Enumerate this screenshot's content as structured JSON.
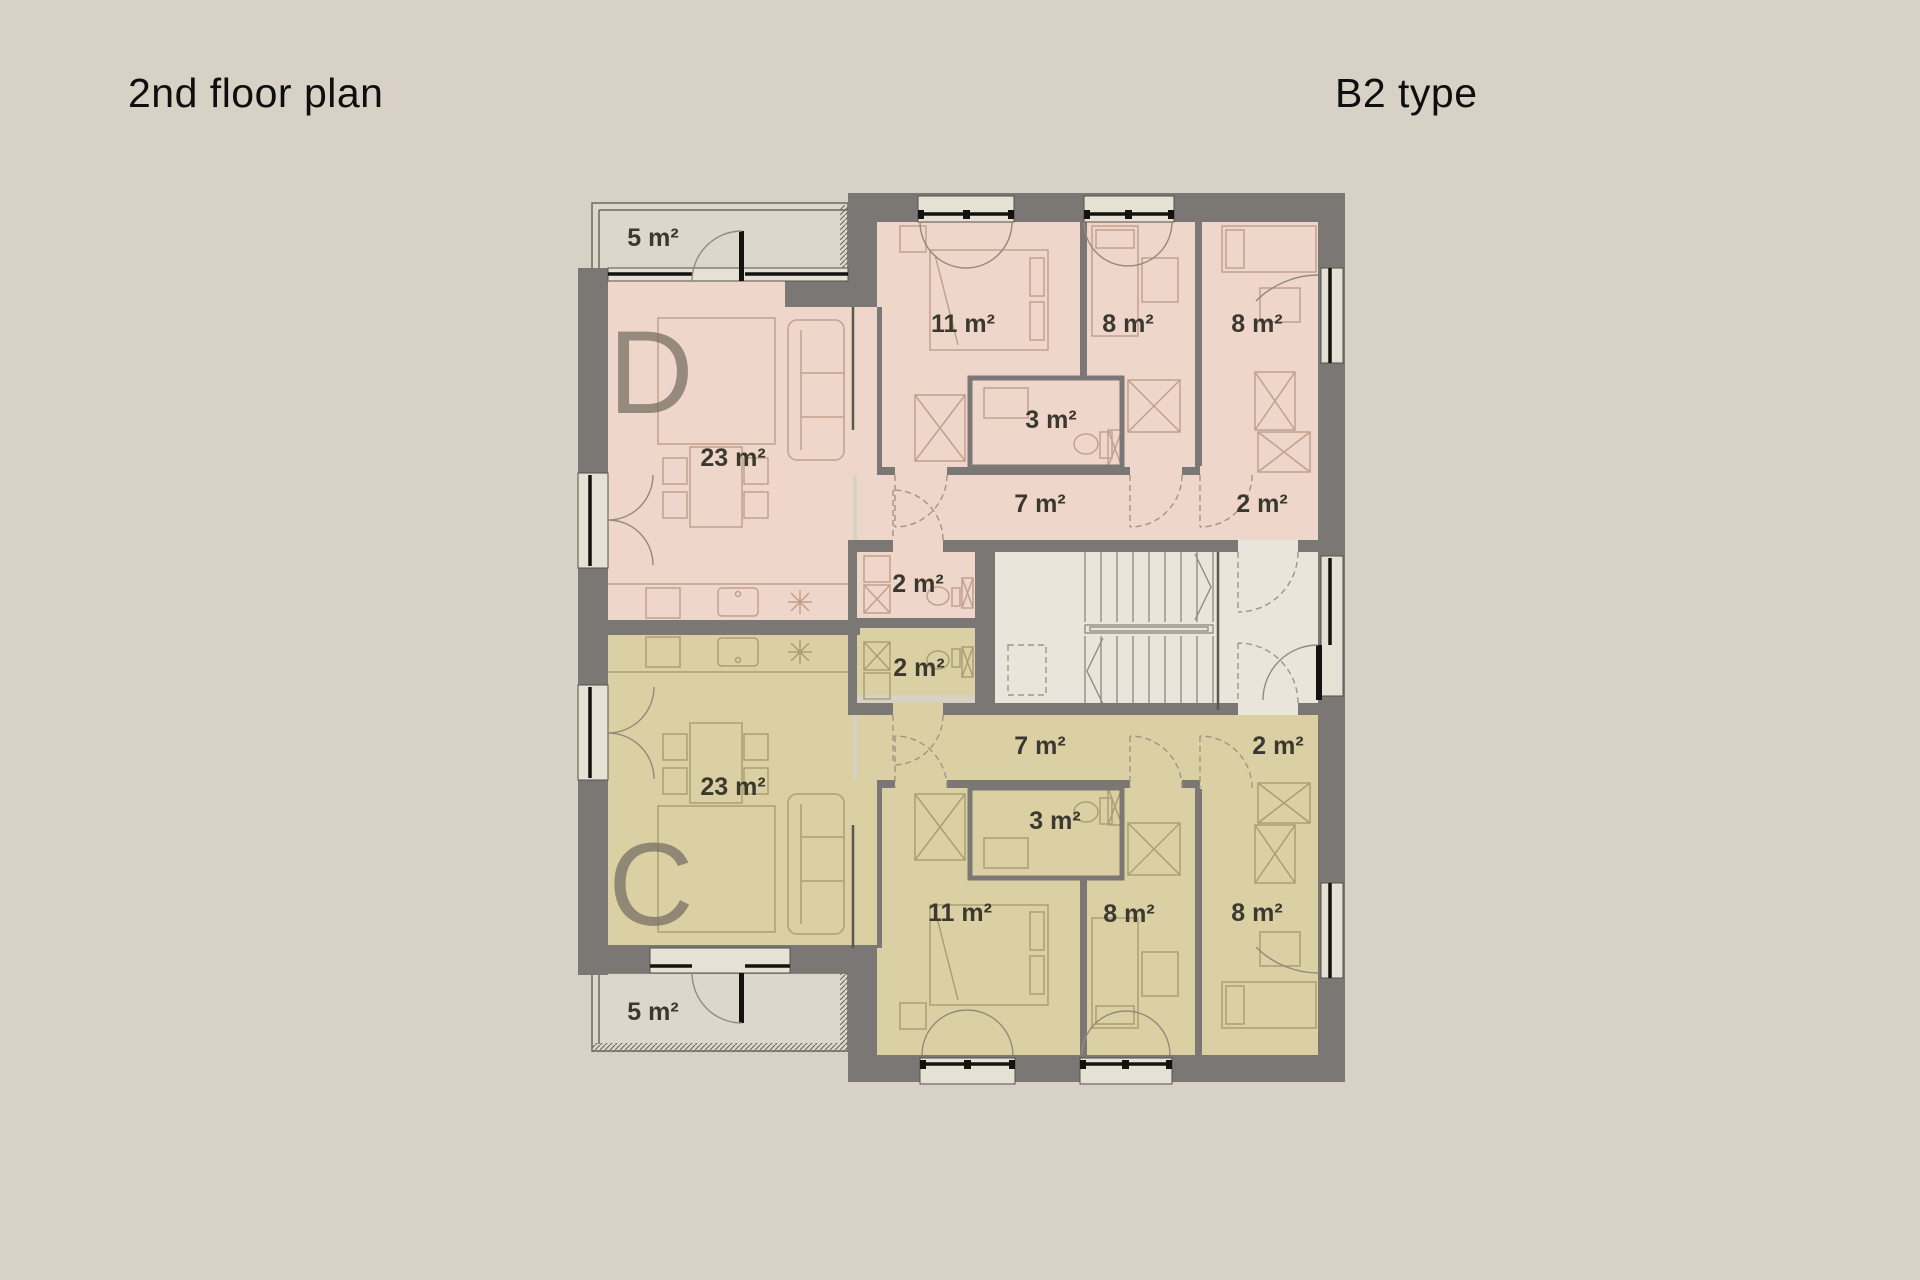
{
  "header": {
    "plan_title": "2nd floor plan",
    "type_label": "B2 type"
  },
  "units": {
    "d": {
      "letter": "D",
      "rooms": {
        "balcony": "5 m²",
        "living": "23 m²",
        "bedroom_1": "11 m²",
        "bedroom_2": "8 m²",
        "bedroom_3": "8 m²",
        "bathroom": "3 m²",
        "hallway": "7 m²",
        "entry": "2 m²",
        "wc": "2 m²"
      }
    },
    "c": {
      "letter": "C",
      "rooms": {
        "balcony": "5 m²",
        "living": "23 m²",
        "bedroom_1": "11 m²",
        "bedroom_2": "8 m²",
        "bedroom_3": "8 m²",
        "bathroom": "3 m²",
        "hallway": "7 m²",
        "entry": "2 m²",
        "wc": "2 m²"
      }
    }
  },
  "colors": {
    "background": "#d8d2c6",
    "wall": "#7b7774",
    "unit_d_fill": "#efd6ca",
    "unit_c_fill": "#dad0a4",
    "stair_fill": "#e9e5db",
    "balcony_fill": "#dcd7cb",
    "text": "#3b382f"
  }
}
